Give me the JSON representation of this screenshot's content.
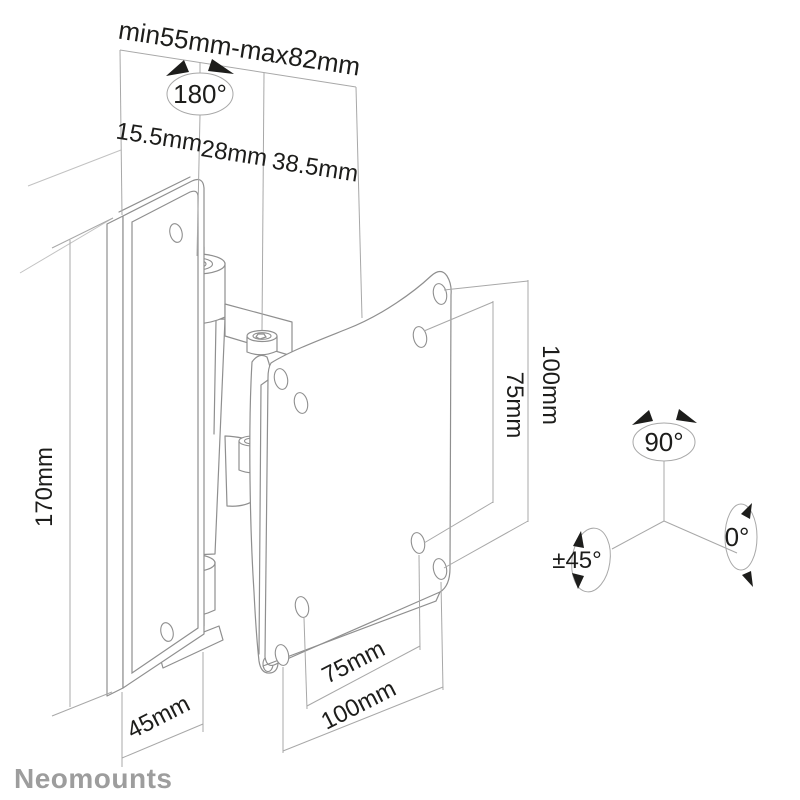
{
  "brand": {
    "logo_text": "Neomounts"
  },
  "labels": {
    "top_span": "min55mm-max82mm",
    "segment_left": "15.5mm",
    "segment_mid": "28mm",
    "segment_right": "38.5mm",
    "plate_height": "170mm",
    "vesa_side_inner": "75mm",
    "vesa_side_outer": "100mm",
    "vesa_bottom_inner": "75mm",
    "vesa_bottom_outer": "100mm",
    "depth": "45mm",
    "swivel": "180°",
    "rotate_portrait": "90°",
    "tilt": "±45°",
    "level": "0°"
  },
  "colors": {
    "background": "#ffffff",
    "drawing_line": "#8f8f8f",
    "dimension_line": "#a8a8a8",
    "label_text": "#1d1d1b",
    "logo_text": "#9d9d9d"
  }
}
